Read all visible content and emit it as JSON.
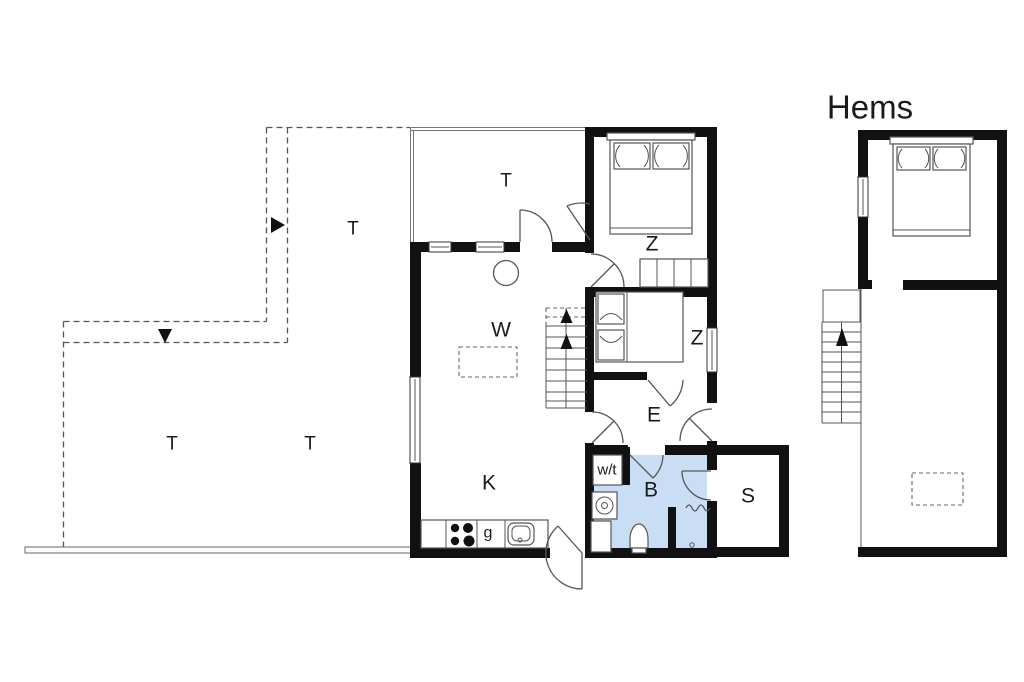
{
  "diagram_type": "floor-plan",
  "loft": {
    "title": "Hems"
  },
  "rooms": {
    "terrace_top": "T",
    "terrace_upper_left": "T",
    "terrace_lower_left": "T",
    "terrace_lower_mid": "T",
    "bedroom_main": "Z",
    "bedroom_second": "Z",
    "living_room": "W",
    "entry": "E",
    "kitchen": "K",
    "bathroom": "B",
    "storage": "S",
    "utility": "w/t",
    "cooker": "g"
  },
  "colors": {
    "wall": "#111111",
    "bathroom_fill": "#c9def5",
    "line": "#555555",
    "text": "#1a1a1a",
    "background": "#ffffff"
  }
}
